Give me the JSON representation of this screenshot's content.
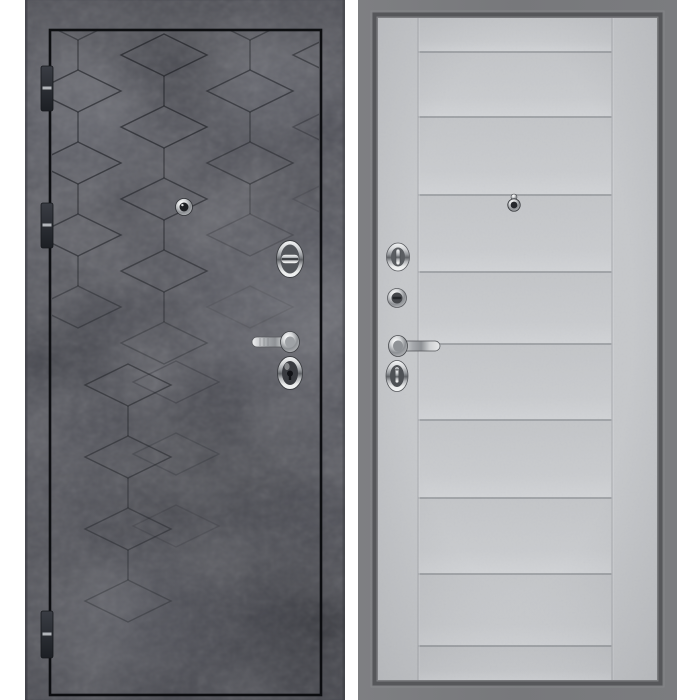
{
  "meta": {
    "description": "Product photo of a steel entrance door shown from both sides: exterior finished in dark concrete with an engraved tumbling-cube pattern, interior finished in light grey with horizontal moldings",
    "exterior_label": "exterior-side-dark-concrete",
    "interior_label": "interior-side-light-grey"
  },
  "colors": {
    "background": "#ffffff",
    "exterior_base": "#4e4f57",
    "exterior_pattern_line": "#1b1d22",
    "exterior_frame_line": "#0d0e11",
    "hinge_dark": "#23262b",
    "hinge_light": "#caccd1",
    "interior_frame": "#77787b",
    "interior_frame_dark": "#56575a",
    "interior_leaf": "#c6c8cb",
    "interior_groove": "#999ca0",
    "interior_stile": "#b0b2b6",
    "chrome_light": "#f4f5f6",
    "chrome_mid": "#9a9da1",
    "chrome_dark": "#5f6266",
    "hardware_inner_dark": "#3a3c41"
  },
  "exterior_view": {
    "label": "exterior-side",
    "hinges": [
      {
        "y": 66,
        "h": 45
      },
      {
        "y": 203,
        "h": 45
      },
      {
        "y": 611,
        "h": 47
      }
    ],
    "pattern_shapes": [
      {
        "t": "d",
        "x": 53,
        "y": 19,
        "o": 0.45
      },
      {
        "t": "v",
        "x": 53,
        "y": 40,
        "o": 0.5
      },
      {
        "t": "d",
        "x": 53,
        "y": 91,
        "o": 0.6
      },
      {
        "t": "v",
        "x": 53,
        "y": 112,
        "o": 0.55
      },
      {
        "t": "d",
        "x": 53,
        "y": 163,
        "o": 0.6
      },
      {
        "t": "v",
        "x": 53,
        "y": 184,
        "o": 0.5
      },
      {
        "t": "d",
        "x": 53,
        "y": 235,
        "o": 0.55
      },
      {
        "t": "v",
        "x": 53,
        "y": 256,
        "o": 0.45
      },
      {
        "t": "d",
        "x": 53,
        "y": 307,
        "o": 0.4
      },
      {
        "t": "d",
        "x": 139,
        "y": 55,
        "o": 0.62
      },
      {
        "t": "v",
        "x": 139,
        "y": 76,
        "o": 0.55
      },
      {
        "t": "d",
        "x": 139,
        "y": 127,
        "o": 0.6
      },
      {
        "t": "v",
        "x": 139,
        "y": 148,
        "o": 0.5
      },
      {
        "t": "d",
        "x": 139,
        "y": 199,
        "o": 0.55
      },
      {
        "t": "v",
        "x": 139,
        "y": 220,
        "o": 0.5
      },
      {
        "t": "d",
        "x": 139,
        "y": 271,
        "o": 0.5
      },
      {
        "t": "v",
        "x": 139,
        "y": 292,
        "o": 0.4
      },
      {
        "t": "d",
        "x": 139,
        "y": 343,
        "o": 0.3
      },
      {
        "t": "d",
        "x": 225,
        "y": 19,
        "o": 0.45
      },
      {
        "t": "v",
        "x": 225,
        "y": 40,
        "o": 0.45
      },
      {
        "t": "d",
        "x": 225,
        "y": 91,
        "o": 0.55
      },
      {
        "t": "v",
        "x": 225,
        "y": 112,
        "o": 0.45
      },
      {
        "t": "d",
        "x": 225,
        "y": 163,
        "o": 0.45
      },
      {
        "t": "v",
        "x": 225,
        "y": 184,
        "o": 0.3
      },
      {
        "t": "d",
        "x": 225,
        "y": 235,
        "o": 0.22
      },
      {
        "t": "d",
        "x": 225,
        "y": 307,
        "o": 0.1
      },
      {
        "t": "d",
        "x": 311,
        "y": 55,
        "o": 0.5
      },
      {
        "t": "v",
        "x": 311,
        "y": 76,
        "o": 0.4
      },
      {
        "t": "d",
        "x": 311,
        "y": 127,
        "o": 0.32
      },
      {
        "t": "d",
        "x": 311,
        "y": 199,
        "o": 0.14
      },
      {
        "t": "d",
        "x": 103,
        "y": 385,
        "o": 0.5
      },
      {
        "t": "v",
        "x": 103,
        "y": 406,
        "o": 0.45
      },
      {
        "t": "d",
        "x": 151,
        "y": 382,
        "o": 0.25
      },
      {
        "t": "d",
        "x": 103,
        "y": 457,
        "o": 0.45
      },
      {
        "t": "v",
        "x": 103,
        "y": 478,
        "o": 0.4
      },
      {
        "t": "d",
        "x": 151,
        "y": 454,
        "o": 0.2
      },
      {
        "t": "d",
        "x": 103,
        "y": 529,
        "o": 0.4
      },
      {
        "t": "v",
        "x": 103,
        "y": 550,
        "o": 0.35
      },
      {
        "t": "d",
        "x": 151,
        "y": 526,
        "o": 0.15
      },
      {
        "t": "d",
        "x": 103,
        "y": 601,
        "o": 0.3
      }
    ],
    "hardware": [
      "peephole",
      "upper-cylinder-escutcheon",
      "lever-handle",
      "lower-cylinder-escutcheon"
    ]
  },
  "interior_view": {
    "label": "interior-side",
    "moldings_y": [
      52,
      117,
      195,
      272,
      344,
      420,
      498,
      574,
      646
    ],
    "stiles_x": [
      60,
      254
    ],
    "hardware": [
      "upper-thumbturn",
      "cylinder-knob",
      "lever-handle",
      "lower-thumbturn",
      "peephole"
    ]
  }
}
